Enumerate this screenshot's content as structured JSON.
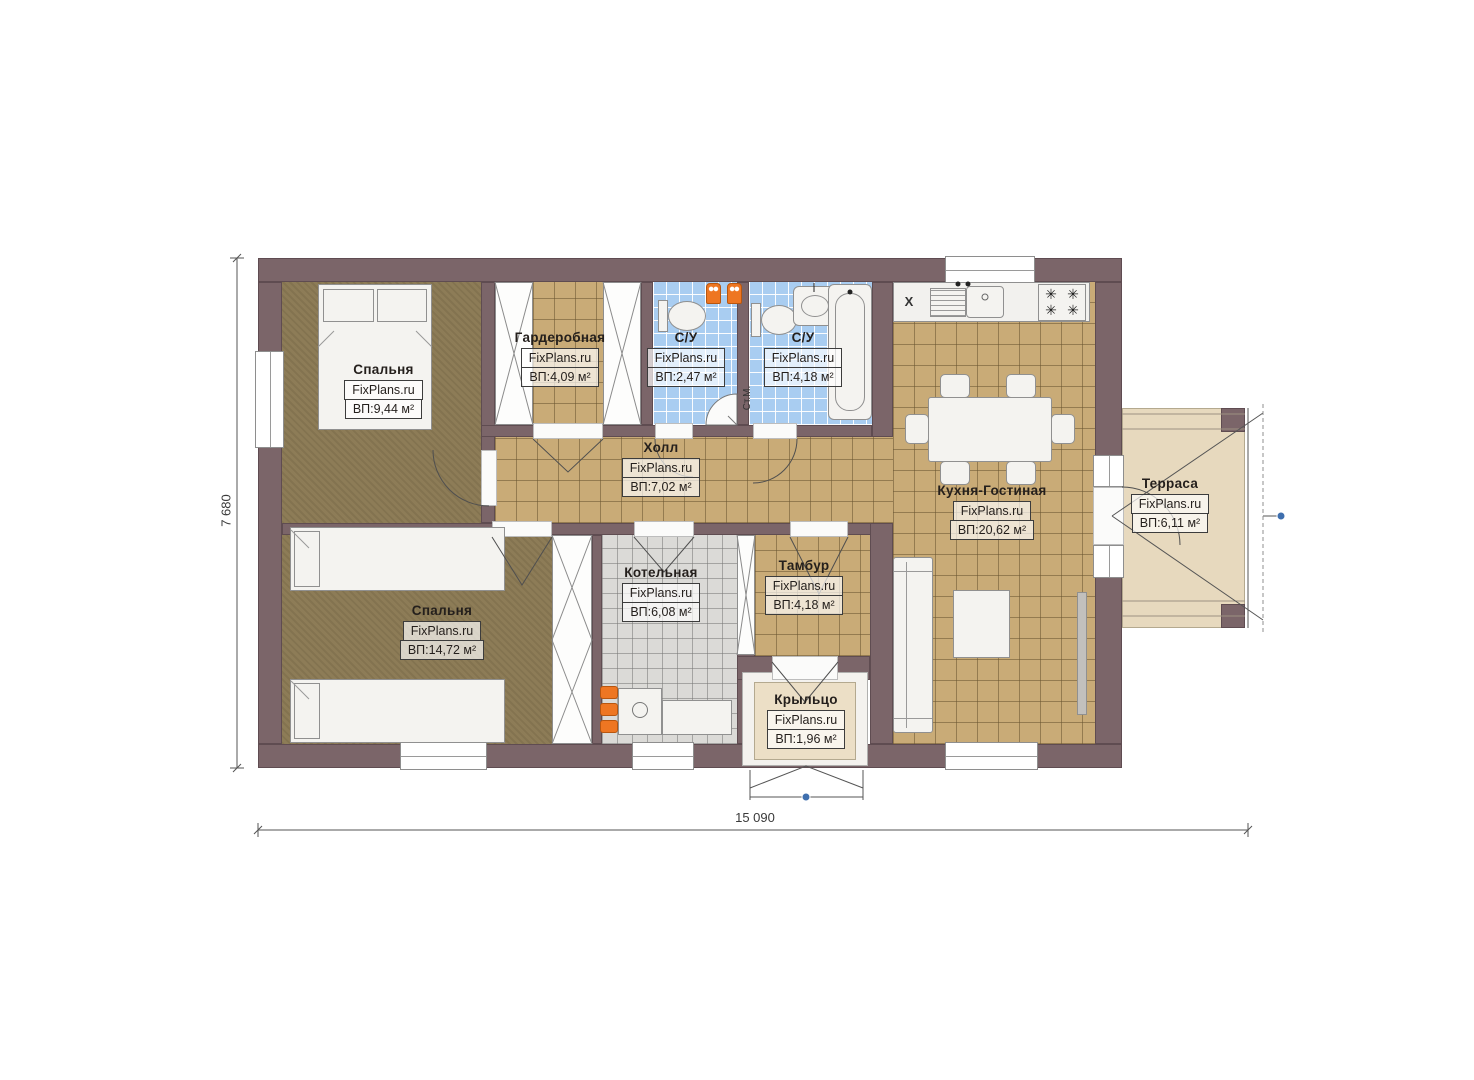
{
  "watermark": "FixPlans.ru",
  "rooms": {
    "bedroom1": {
      "name": "Спальня",
      "area": "ВП:9,44 м²"
    },
    "wardrobe": {
      "name": "Гардеробная",
      "area": "ВП:4,09 м²"
    },
    "bath1": {
      "name": "С/У",
      "area": "ВП:2,47 м²"
    },
    "bath2": {
      "name": "С/У",
      "area": "ВП:4,18 м²"
    },
    "hall": {
      "name": "Холл",
      "area": "ВП:7,02 м²"
    },
    "kitchen_living": {
      "name": "Кухня-Гостиная",
      "area": "ВП:20,62 м²"
    },
    "terrace": {
      "name": "Терраса",
      "area": "ВП:6,11 м²"
    },
    "bedroom2": {
      "name": "Спальня",
      "area": "ВП:14,72 м²"
    },
    "boiler": {
      "name": "Котельная",
      "area": "ВП:6,08 м²"
    },
    "tambour": {
      "name": "Тамбур",
      "area": "ВП:4,18 м²"
    },
    "porch": {
      "name": "Крыльцо",
      "area": "ВП:1,96 м²"
    }
  },
  "dimensions": {
    "overall_width": "15 090",
    "overall_height": "7 680"
  },
  "annotations": {
    "washing_machine": "Ст.М.",
    "fridge_mark": "X"
  },
  "icons": {
    "burner": "✳"
  },
  "colors": {
    "wall": "#7b6569",
    "bedroom_floor": "#8d7c57",
    "tile_floor": "#c9ab77",
    "bathroom_tile": "#a9cdf1",
    "boiler_tile": "#dbdad7",
    "terrace_floor": "#e7d9be",
    "accent_orange": "#ee7622",
    "marker_blue": "#3f6fae"
  }
}
